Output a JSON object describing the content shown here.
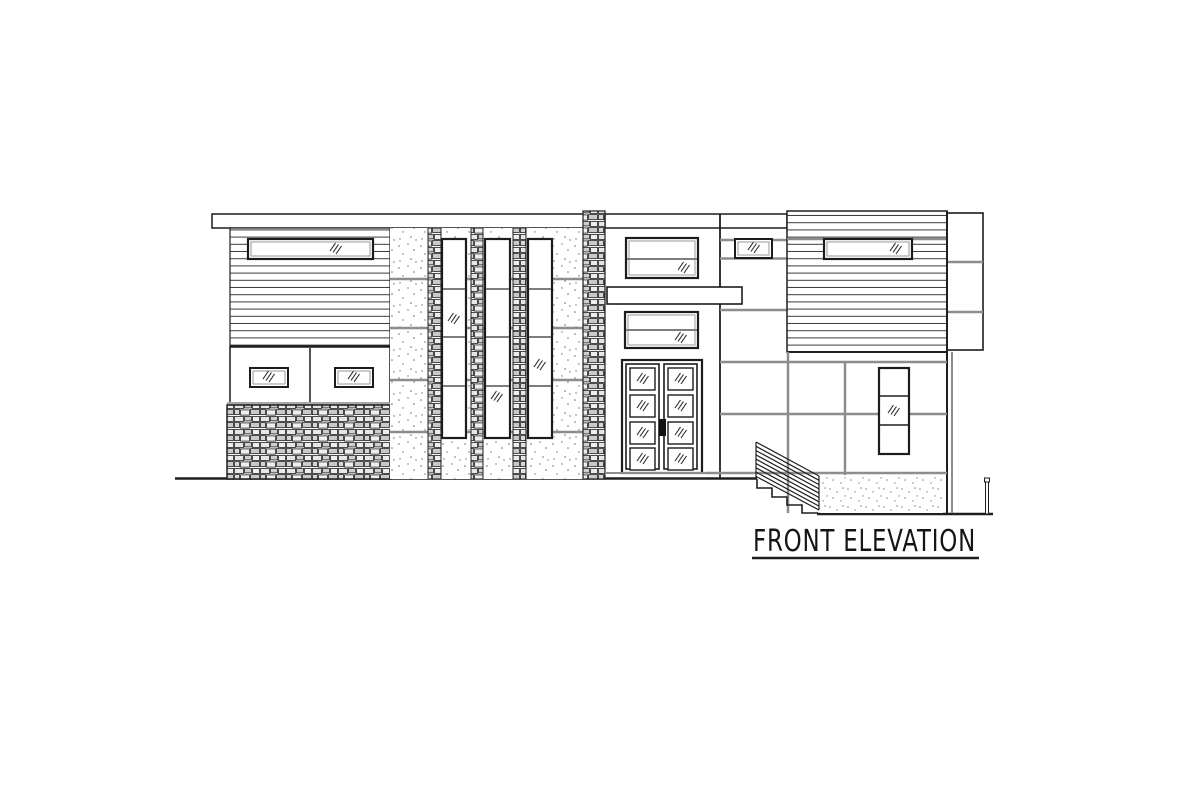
{
  "drawing": {
    "type": "architectural front elevation",
    "title": {
      "label": "FRONT ELEVATION",
      "underlined": true
    },
    "symbols": {
      "glass_mark": "triple-diagonal-slash"
    },
    "materials": {
      "siding": "horizontal lap siding",
      "stone": "stacked stone veneer",
      "stucco": "stippled stucco panels",
      "concrete": "stippled concrete base"
    },
    "colors": {
      "ink": "#1f1f1f",
      "reveal_gray": "#8d8d8d",
      "paper": "#ffffff",
      "stone_light": "#ececec",
      "stone_mid": "#d2d2d2",
      "handle_black": "#111111"
    }
  }
}
